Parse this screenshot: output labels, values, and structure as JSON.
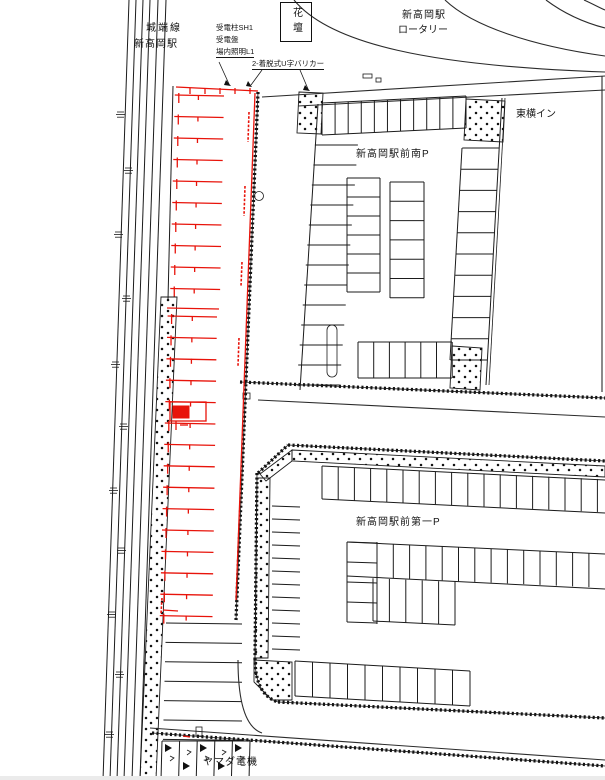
{
  "drawing": {
    "title_context": "site plan",
    "railway": {
      "line_name": "城端線",
      "station": "新高岡駅"
    },
    "rotary": {
      "line1": "新高岡駅",
      "line2": "ロータリー"
    },
    "flower_bed": "花壇",
    "equipment_note": {
      "l1": "受電柱SH1",
      "l2": "受電盤",
      "l3": "場内照明L1"
    },
    "bollard_note": "2-着脱式U字バリカー",
    "hotel": "東横イン",
    "south_parking": "新高岡駅前南P",
    "first_parking": "新高岡駅前第一P",
    "yamada": "ヤマダ電機",
    "colors": {
      "new_work_red": "#e8130a",
      "line_black": "#1b1b1b",
      "background": "#ffffff"
    }
  }
}
